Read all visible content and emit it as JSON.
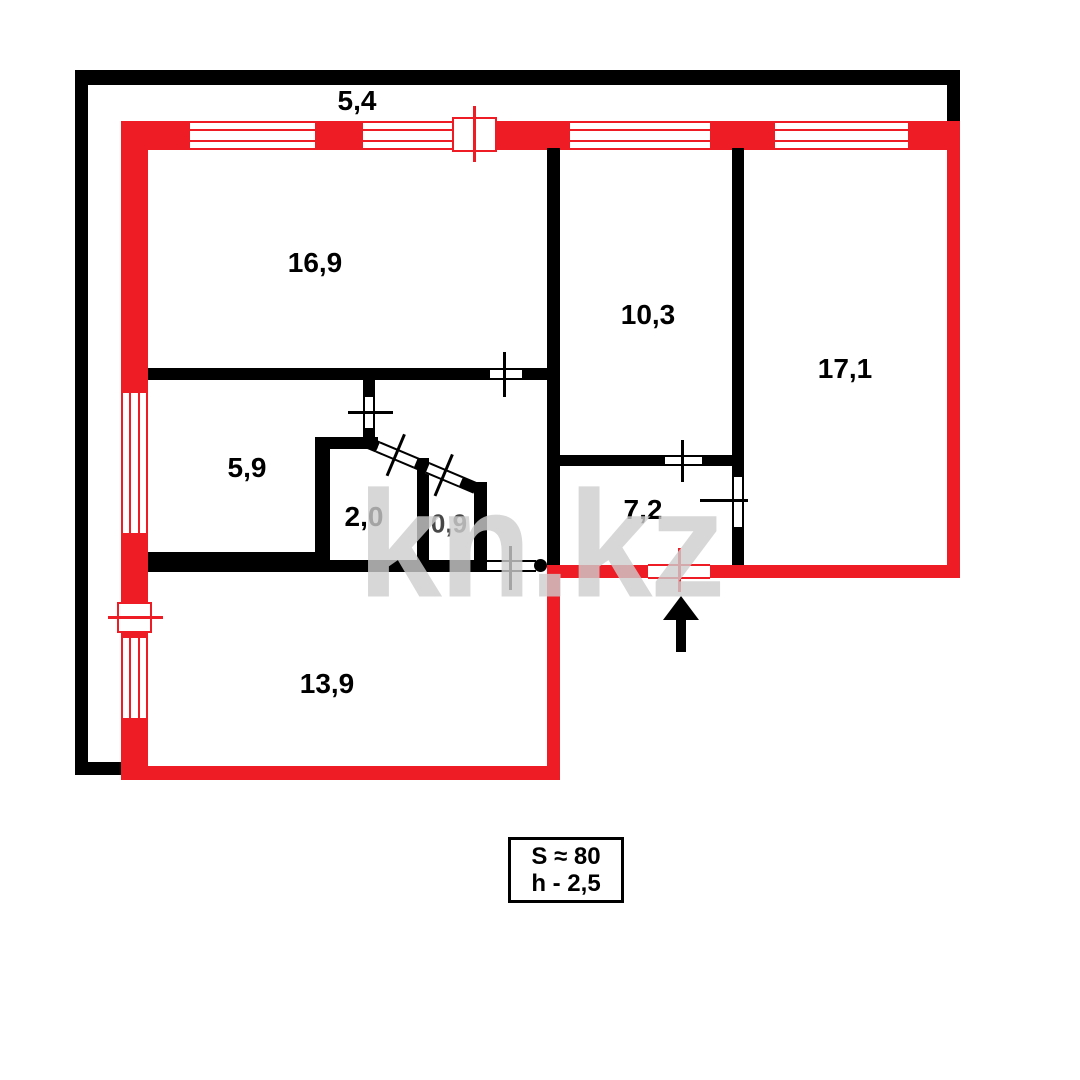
{
  "title": "apartment-floor-plan",
  "balcony": {
    "dimension": "5,4"
  },
  "rooms": [
    {
      "id": "living-room",
      "area": "16,9"
    },
    {
      "id": "bedroom-top",
      "area": "10,3"
    },
    {
      "id": "bedroom-right",
      "area": "17,1"
    },
    {
      "id": "kitchen",
      "area": "5,9"
    },
    {
      "id": "bathroom",
      "area": "2,0"
    },
    {
      "id": "toilet",
      "area": "0,9"
    },
    {
      "id": "hallway",
      "area": "7,2"
    },
    {
      "id": "room-bottom",
      "area": "13,9"
    }
  ],
  "info_box": {
    "total_area": "S ≈ 80",
    "ceiling_height": "h - 2,5"
  },
  "watermark": "kn.kz",
  "colors": {
    "wall_red": "#ee1c24",
    "wall_black": "#000000",
    "watermark_gray": "#cdcdcd"
  }
}
